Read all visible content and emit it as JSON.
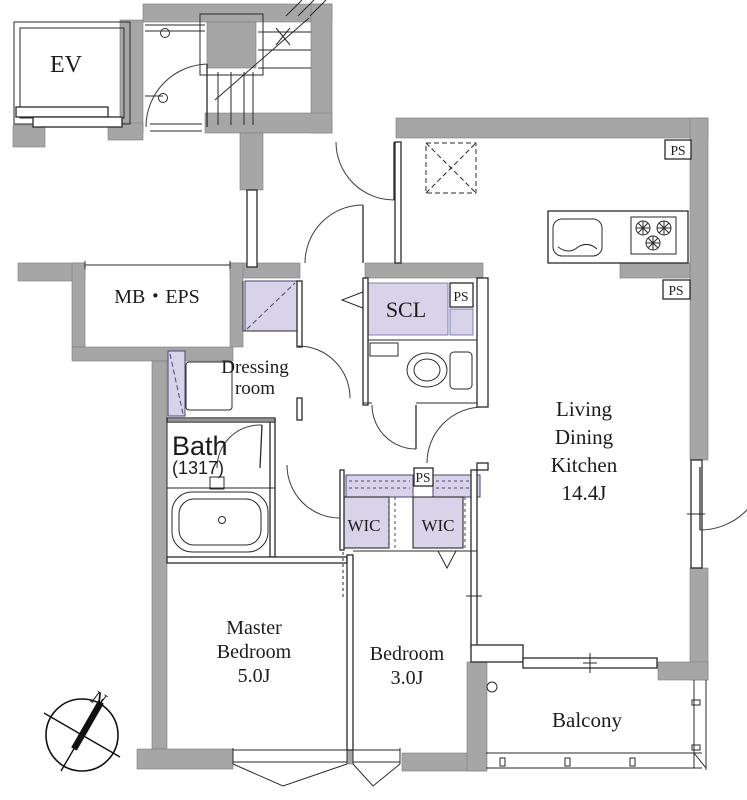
{
  "rooms": {
    "ev": {
      "label": "EV"
    },
    "mb_eps": {
      "label": "MB・EPS"
    },
    "scl": {
      "label": "SCL"
    },
    "dressing": {
      "lines": [
        "Dressing",
        "room"
      ]
    },
    "bath": {
      "lines": [
        "Bath",
        "(1317)"
      ]
    },
    "ldk": {
      "lines": [
        "Living",
        "Dining",
        "Kitchen",
        "14.4J"
      ]
    },
    "wic_left": {
      "label": "WIC"
    },
    "wic_right": {
      "label": "WIC"
    },
    "master_bedroom": {
      "lines": [
        "Master",
        "Bedroom",
        "5.0J"
      ]
    },
    "bedroom": {
      "lines": [
        "Bedroom",
        "3.0J"
      ]
    },
    "balcony": {
      "label": "Balcony"
    }
  },
  "shafts": {
    "ps": "PS"
  },
  "compass": {
    "north": "N"
  },
  "colors": {
    "wall": "#a6a6a6",
    "closet": "#d8d3e8",
    "line": "#2a2a2a",
    "background": "#ffffff"
  }
}
